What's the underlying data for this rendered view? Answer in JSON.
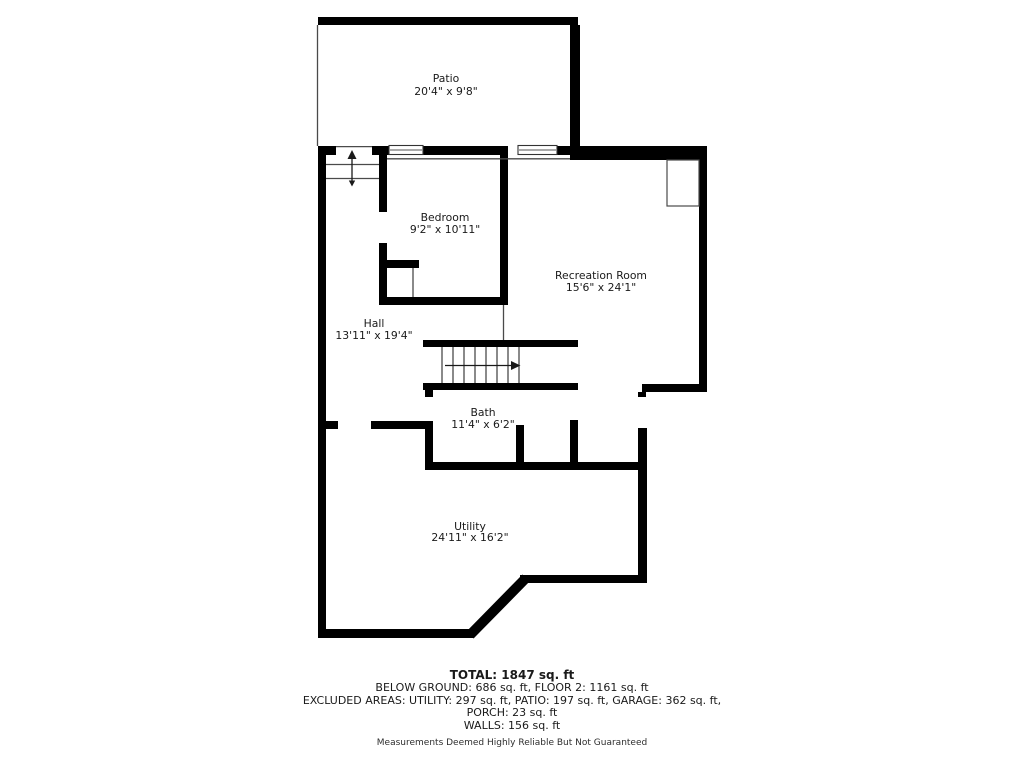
{
  "colors": {
    "background": "#ffffff",
    "wall": "#000000",
    "thin_line": "#4a4a4a",
    "text": "#1a1a1a",
    "disclaimer_text": "#2e2e2e"
  },
  "floor_plan": {
    "rooms": [
      {
        "id": "patio",
        "name": "Patio",
        "dimensions": "20'4\" x 9'8\""
      },
      {
        "id": "bedroom",
        "name": "Bedroom",
        "dimensions": "9'2\" x 10'11\""
      },
      {
        "id": "recreation-room",
        "name": "Recreation Room",
        "dimensions": "15'6\" x 24'1\""
      },
      {
        "id": "hall",
        "name": "Hall",
        "dimensions": "13'11\" x 19'4\""
      },
      {
        "id": "bath",
        "name": "Bath",
        "dimensions": "11'4\" x 6'2\""
      },
      {
        "id": "utility",
        "name": "Utility",
        "dimensions": "24'11\" x 16'2\""
      }
    ]
  },
  "summary": {
    "total": "TOTAL: 1847 sq. ft",
    "areas_line": "BELOW GROUND: 686 sq. ft, FLOOR 2: 1161 sq. ft",
    "excluded_line_1": "EXCLUDED AREAS: UTILITY: 297 sq. ft, PATIO: 197 sq. ft, GARAGE: 362 sq. ft,",
    "excluded_line_2": "PORCH: 23 sq. ft",
    "walls_line": "WALLS: 156 sq. ft",
    "disclaimer": "Measurements Deemed Highly Reliable But Not Guaranteed"
  }
}
